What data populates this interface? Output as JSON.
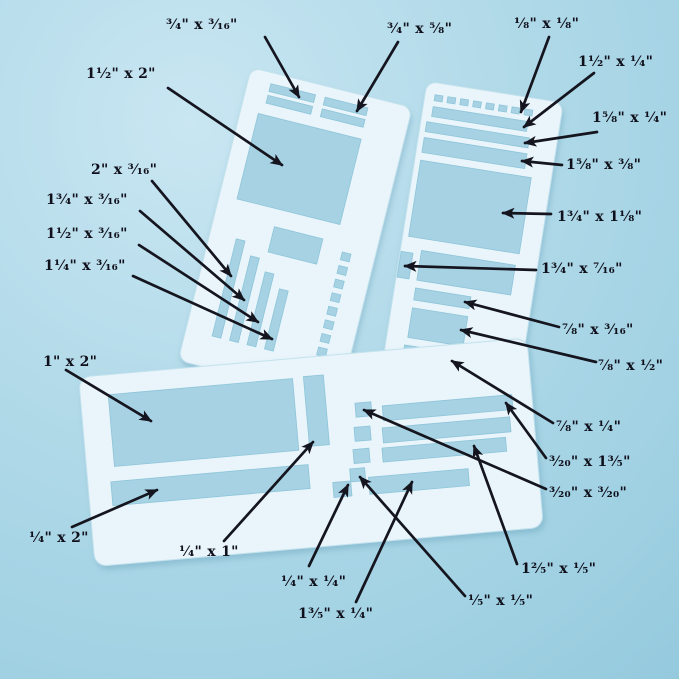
{
  "scene": {
    "description": "Three translucent craft stencil templates on a light blue surface, annotated with arrows and cutout dimensions",
    "background_color": "#aed8e8",
    "stencil_color": "#e9f5fa",
    "cutout_color": "#a6d2e3",
    "annotation_color": "#15151f"
  },
  "annotations": [
    {
      "text": "³⁄₄\" x ³⁄₁₆\""
    },
    {
      "text": "³⁄₄\" x ⁵⁄₈\""
    },
    {
      "text": "¹⁄₈\" x ¹⁄₈\""
    },
    {
      "text": "1¹⁄₂\" x ¹⁄₄\""
    },
    {
      "text": "1⁵⁄₈\" x ¹⁄₄\""
    },
    {
      "text": "1⁵⁄₈\" x ³⁄₈\""
    },
    {
      "text": "1¹⁄₂\" x 2\""
    },
    {
      "text": "2\" x ³⁄₁₆\""
    },
    {
      "text": "1³⁄₄\" x ³⁄₁₆\""
    },
    {
      "text": "1¹⁄₂\" x ³⁄₁₆\""
    },
    {
      "text": "1¹⁄₄\" x ³⁄₁₆\""
    },
    {
      "text": "1³⁄₄\" x 1¹⁄₈\""
    },
    {
      "text": "1³⁄₄\" x ⁷⁄₁₆\""
    },
    {
      "text": "⁷⁄₈\" x ³⁄₁₆\""
    },
    {
      "text": "⁷⁄₈\" x ¹⁄₂\""
    },
    {
      "text": "⁷⁄₈\" x ¹⁄₄\""
    },
    {
      "text": "³⁄₂₀\" x 1³⁄₅\""
    },
    {
      "text": "³⁄₂₀\" x ³⁄₂₀\""
    },
    {
      "text": "1²⁄₅\" x ¹⁄₅\""
    },
    {
      "text": "¹⁄₅\" x ¹⁄₅\""
    },
    {
      "text": "1\" x 2\""
    },
    {
      "text": "¹⁄₄\" x 2\""
    },
    {
      "text": "¹⁄₄\" x 1\""
    },
    {
      "text": "¹⁄₄\" x ¹⁄₄\""
    },
    {
      "text": "1³⁄₅\" x ¹⁄₄\""
    }
  ]
}
